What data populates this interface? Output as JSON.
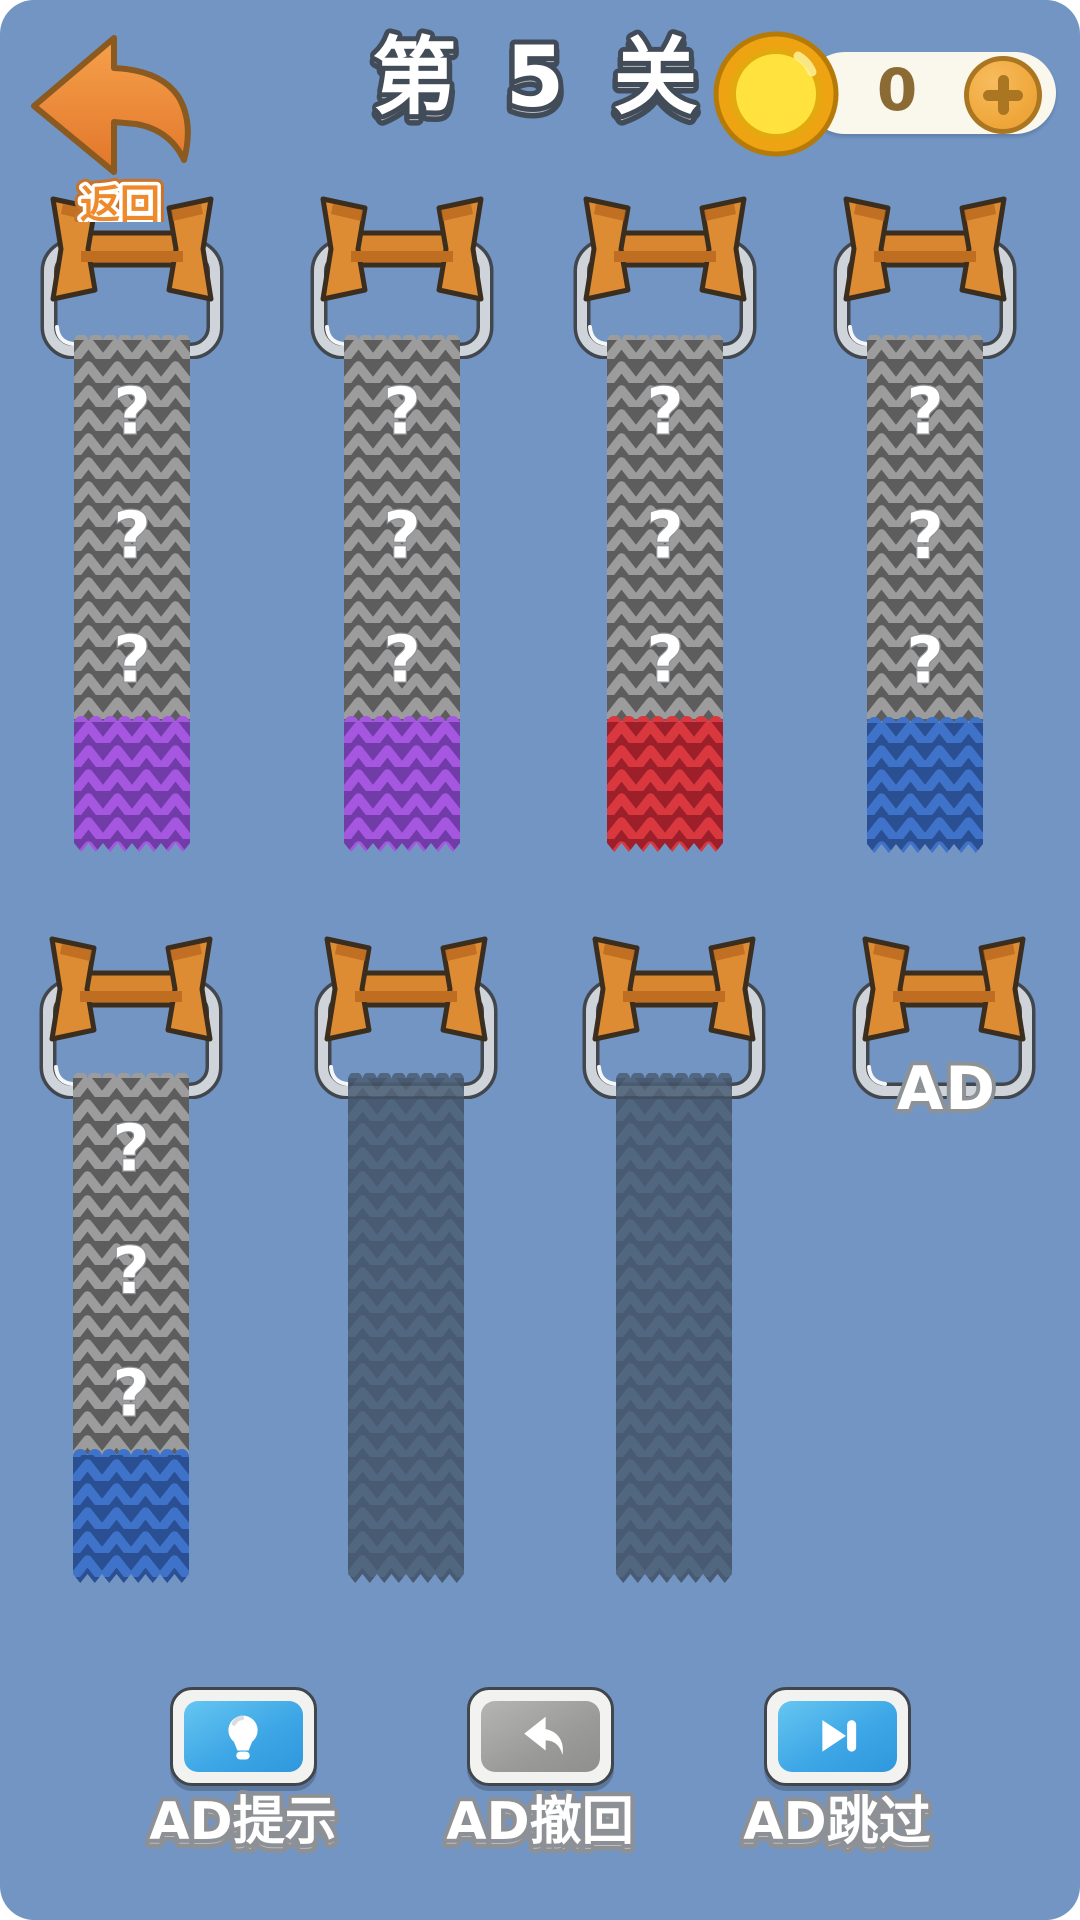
{
  "header": {
    "back_label": "返回",
    "level_title": "第 5 关",
    "coins": "0"
  },
  "board": {
    "strip_width": 116,
    "question_mark": "?",
    "ad_label": "AD",
    "colors": {
      "gray": {
        "stitch": "#9c9c9c",
        "gap": "#5d5d5d"
      },
      "purple": {
        "stitch": "#a557e0",
        "gap": "#713ba8"
      },
      "red": {
        "stitch": "#d8383e",
        "gap": "#9c1f2a"
      },
      "blue": {
        "stitch": "#3e73c9",
        "gap": "#2a4f92"
      },
      "dark": {
        "stitch": "#4d6076",
        "gap": "#435468"
      }
    },
    "spools": [
      {
        "cx": 132,
        "top": 193,
        "strip": {
          "segments": [
            {
              "color": "gray",
              "h": 382,
              "marks": 3
            },
            {
              "color": "purple",
              "h": 132,
              "marks": 0
            }
          ],
          "top": 335
        }
      },
      {
        "cx": 402,
        "top": 193,
        "strip": {
          "segments": [
            {
              "color": "gray",
              "h": 382,
              "marks": 3
            },
            {
              "color": "purple",
              "h": 132,
              "marks": 0
            }
          ],
          "top": 335
        }
      },
      {
        "cx": 665,
        "top": 193,
        "strip": {
          "segments": [
            {
              "color": "gray",
              "h": 382,
              "marks": 3
            },
            {
              "color": "red",
              "h": 132,
              "marks": 0
            }
          ],
          "top": 335
        }
      },
      {
        "cx": 925,
        "top": 193,
        "strip": {
          "segments": [
            {
              "color": "gray",
              "h": 383,
              "marks": 3
            },
            {
              "color": "blue",
              "h": 132,
              "marks": 0
            }
          ],
          "top": 335
        }
      },
      {
        "cx": 131,
        "top": 933,
        "strip": {
          "segments": [
            {
              "color": "gray",
              "h": 377,
              "marks": 3
            },
            {
              "color": "blue",
              "h": 130,
              "marks": 0
            }
          ],
          "top": 1073
        }
      },
      {
        "cx": 406,
        "top": 933,
        "strip": {
          "segments": [
            {
              "color": "dark",
              "h": 507,
              "marks": 0
            }
          ],
          "top": 1073,
          "dark": true
        }
      },
      {
        "cx": 674,
        "top": 933,
        "strip": {
          "segments": [
            {
              "color": "dark",
              "h": 507,
              "marks": 0
            }
          ],
          "top": 1073,
          "dark": true
        }
      },
      {
        "cx": 944,
        "top": 933,
        "strip": null,
        "ad": true
      }
    ]
  },
  "footer": {
    "buttons": [
      {
        "label": "AD提示",
        "icon": "lightbulb-icon",
        "style": "blue"
      },
      {
        "label": "AD撤回",
        "icon": "undo-icon",
        "style": "gray"
      },
      {
        "label": "AD跳过",
        "icon": "skip-icon",
        "style": "blue"
      }
    ]
  }
}
